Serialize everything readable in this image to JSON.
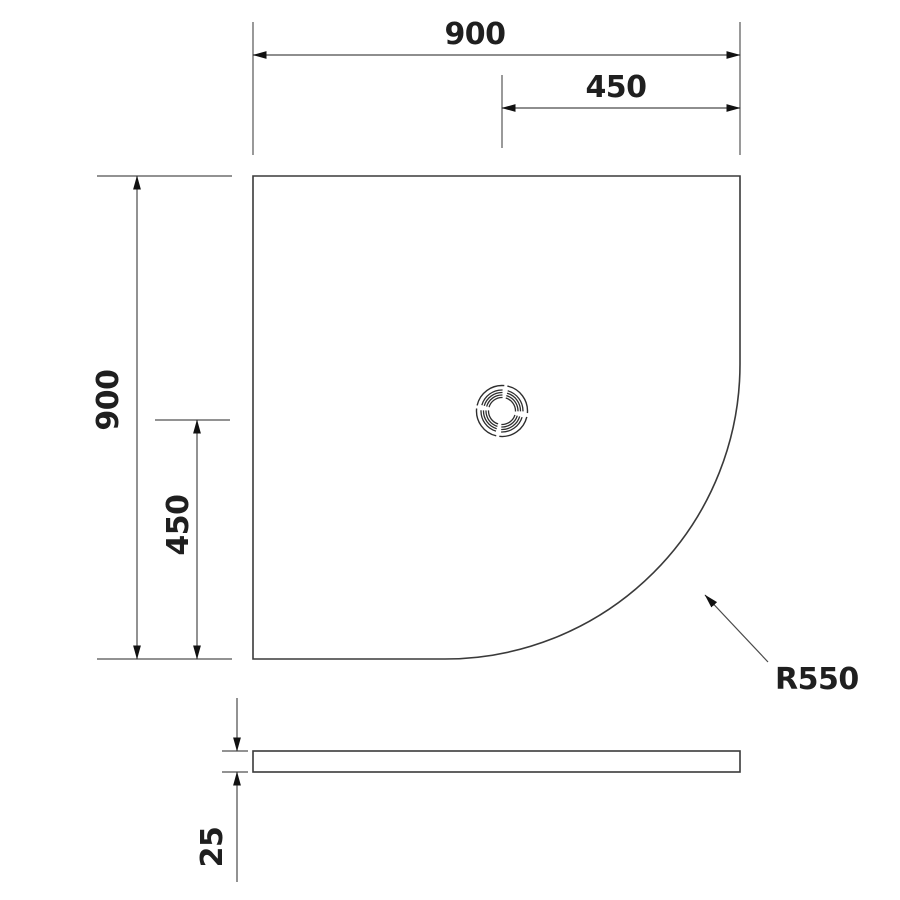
{
  "dimensions": {
    "plan_width": "900",
    "plan_half_width": "450",
    "plan_height": "900",
    "plan_half_height": "450",
    "corner_radius": "R550",
    "side_thickness": "25"
  },
  "colors": {
    "background": "#ffffff",
    "outline": "#3a3a3a",
    "dimension_line": "#4a4a4a",
    "extension_line": "#6e6e6e",
    "arrowhead": "#111111",
    "text": "#1f1f1f"
  }
}
